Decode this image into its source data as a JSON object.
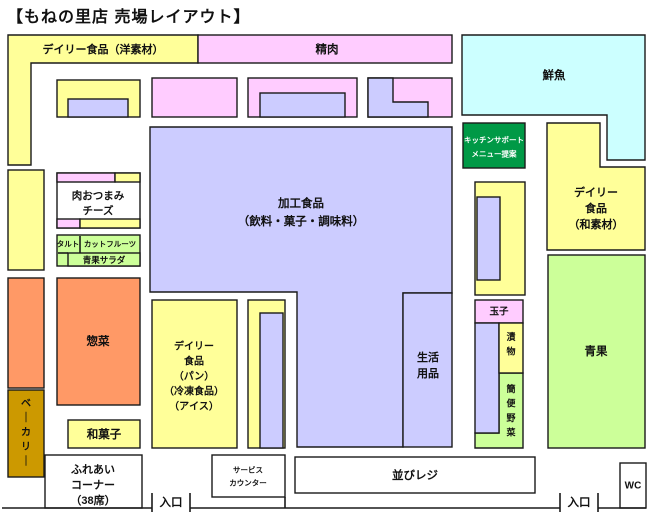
{
  "title": "【もねの里店 売場レイアウト】",
  "palette": {
    "yellow": "#FFFF99",
    "pink": "#FFCCFF",
    "lavender": "#CCCCFF",
    "cyan": "#CCFFFF",
    "green": "#009946",
    "lightgreen": "#CCFF99",
    "orange": "#FF9966",
    "gold": "#CC9900",
    "white": "#FFFFFF",
    "border": "#1A1A1A",
    "text": "#111111"
  },
  "blocks": [
    {
      "name": "daily-west",
      "points": [
        [
          8,
          35
        ],
        [
          198,
          35
        ],
        [
          198,
          63
        ],
        [
          31,
          63
        ],
        [
          31,
          165
        ],
        [
          8,
          165
        ]
      ],
      "fill": "yellow",
      "label": {
        "text": "デイリー食品（洋素材）",
        "x": 103,
        "y": 50,
        "size": 11
      }
    },
    {
      "name": "meat",
      "rect": [
        198,
        35,
        254,
        28
      ],
      "fill": "pink",
      "label": {
        "text": "精肉",
        "x": 327,
        "y": 50,
        "size": 11.5
      }
    },
    {
      "name": "fresh-fish",
      "points": [
        [
          462,
          35
        ],
        [
          645,
          35
        ],
        [
          645,
          160
        ],
        [
          607,
          160
        ],
        [
          607,
          115
        ],
        [
          462,
          115
        ]
      ],
      "fill": "cyan",
      "label": {
        "text": "鮮魚",
        "x": 554,
        "y": 76,
        "size": 11.5
      }
    },
    {
      "name": "shelf-a",
      "rect": [
        57,
        80,
        83,
        37
      ],
      "fill": "yellow"
    },
    {
      "name": "shelf-a-inner",
      "rect": [
        68,
        99,
        60,
        18
      ],
      "fill": "lavender"
    },
    {
      "name": "shelf-b",
      "rect": [
        152,
        78,
        85,
        39
      ],
      "fill": "pink"
    },
    {
      "name": "shelf-c",
      "rect": [
        248,
        78,
        109,
        39
      ],
      "fill": "pink"
    },
    {
      "name": "shelf-c-inner",
      "rect": [
        260,
        93,
        85,
        24
      ],
      "fill": "lavender"
    },
    {
      "name": "shelf-d",
      "rect": [
        368,
        78,
        84,
        39
      ],
      "fill": "pink"
    },
    {
      "name": "shelf-d-inner",
      "points": [
        [
          368,
          78
        ],
        [
          393,
          78
        ],
        [
          393,
          102
        ],
        [
          428,
          102
        ],
        [
          428,
          117
        ],
        [
          368,
          117
        ]
      ],
      "fill": "lavender"
    },
    {
      "name": "processed-food",
      "points": [
        [
          150,
          127
        ],
        [
          452,
          127
        ],
        [
          452,
          293
        ],
        [
          403,
          293
        ],
        [
          403,
          447
        ],
        [
          297,
          447
        ],
        [
          297,
          292
        ],
        [
          150,
          292
        ]
      ],
      "fill": "lavender",
      "label": {
        "lines": [
          "加工食品",
          "（飲料・菓子・調味料）"
        ],
        "x": 301,
        "y": 204,
        "size": 11.5,
        "lh": 18
      }
    },
    {
      "name": "household-goods",
      "rect": [
        403,
        293,
        49,
        154
      ],
      "fill": "lavender",
      "label": {
        "lines": [
          "生活",
          "用品"
        ],
        "x": 428,
        "y": 358,
        "size": 11,
        "lh": 16
      }
    },
    {
      "name": "kitchen-support",
      "rect": [
        463,
        123,
        62,
        45
      ],
      "fill": "green",
      "label": {
        "lines": [
          "キッチンサポート",
          "メニュー提案"
        ],
        "x": 494,
        "y": 140,
        "size": 7.5,
        "lh": 14,
        "color": "#FFFFFF"
      }
    },
    {
      "name": "daily-japanese",
      "points": [
        [
          547,
          123
        ],
        [
          600,
          123
        ],
        [
          600,
          167
        ],
        [
          645,
          167
        ],
        [
          645,
          250
        ],
        [
          547,
          250
        ]
      ],
      "fill": "yellow",
      "label": {
        "lines": [
          "デイリー",
          "食品",
          "（和素材）"
        ],
        "x": 596,
        "y": 193,
        "size": 11,
        "lh": 16
      }
    },
    {
      "name": "right-shelf",
      "rect": [
        475,
        182,
        50,
        113
      ],
      "fill": "yellow"
    },
    {
      "name": "right-shelf-inner",
      "rect": [
        477,
        197,
        23,
        83
      ],
      "fill": "lavender"
    },
    {
      "name": "eggs",
      "rect": [
        475,
        300,
        48,
        23
      ],
      "fill": "pink",
      "label": {
        "text": "玉子",
        "x": 499,
        "y": 312,
        "size": 9.5
      }
    },
    {
      "name": "simple-vegetables",
      "points": [
        [
          499,
          373
        ],
        [
          523,
          373
        ],
        [
          523,
          448
        ],
        [
          475,
          448
        ],
        [
          475,
          433
        ],
        [
          499,
          433
        ]
      ],
      "fill": "lightgreen",
      "label": {
        "text": "簡便野菜",
        "x": 511,
        "y": 389,
        "size": 9,
        "lh": 14.5,
        "vertical": true
      }
    },
    {
      "name": "pickles-shelf",
      "rect": [
        475,
        323,
        24,
        110
      ],
      "fill": "lavender"
    },
    {
      "name": "pickles",
      "rect": [
        499,
        323,
        24,
        50
      ],
      "fill": "yellow",
      "label": {
        "text": "漬物",
        "x": 511,
        "y": 337,
        "size": 9,
        "lh": 14.5,
        "vertical": true
      }
    },
    {
      "name": "produce",
      "rect": [
        548,
        255,
        97,
        193
      ],
      "fill": "lightgreen",
      "label": {
        "text": "青果",
        "x": 596,
        "y": 352,
        "size": 11.5
      }
    },
    {
      "name": "left-shelf-2",
      "rect": [
        8,
        170,
        36,
        100
      ],
      "fill": "yellow"
    },
    {
      "name": "meat-snacks",
      "rect": [
        57,
        173,
        83,
        55
      ],
      "fill": "white",
      "label": {
        "lines": [
          "肉おつまみ",
          "チーズ"
        ],
        "x": 98,
        "y": 196,
        "size": 10.5,
        "lh": 15
      }
    },
    {
      "name": "meat-snacks-strip-tl",
      "rect": [
        57,
        173,
        58,
        9
      ],
      "fill": "pink"
    },
    {
      "name": "meat-snacks-strip-tr",
      "rect": [
        115,
        173,
        25,
        9
      ],
      "fill": "yellow"
    },
    {
      "name": "meat-snacks-strip-bl",
      "rect": [
        57,
        219,
        23,
        9
      ],
      "fill": "pink"
    },
    {
      "name": "meat-snacks-strip-br",
      "rect": [
        80,
        219,
        60,
        9
      ],
      "fill": "yellow"
    },
    {
      "name": "fruit-corner",
      "rect": [
        57,
        235,
        83,
        31
      ],
      "fill": "lightgreen"
    },
    {
      "name": "produce-salad",
      "rect": [
        68,
        253,
        72,
        13
      ],
      "fill": "lightgreen",
      "label": {
        "text": "青果サラダ",
        "x": 104,
        "y": 260,
        "size": 8.5
      }
    },
    {
      "name": "tart-label",
      "label": {
        "text": "タルト",
        "x": 68,
        "y": 244,
        "size": 7.5
      }
    },
    {
      "name": "cut-fruit-label",
      "label": {
        "text": "カットフルーツ",
        "x": 110,
        "y": 244,
        "size": 7.5
      }
    },
    {
      "name": "prepared-food",
      "rect": [
        57,
        278,
        83,
        127
      ],
      "fill": "orange",
      "label": {
        "text": "惣菜",
        "x": 98,
        "y": 342,
        "size": 11.5
      }
    },
    {
      "name": "left-strip",
      "rect": [
        8,
        278,
        36,
        110
      ],
      "fill": "orange"
    },
    {
      "name": "bakery",
      "rect": [
        8,
        390,
        36,
        87
      ],
      "fill": "gold",
      "label": {
        "text": "ベーカリー",
        "x": 26,
        "y": 404,
        "size": 10,
        "lh": 14.5,
        "vertical": true
      }
    },
    {
      "name": "japanese-sweets",
      "rect": [
        68,
        420,
        72,
        28
      ],
      "fill": "yellow",
      "label": {
        "text": "和菓子",
        "x": 104,
        "y": 435,
        "size": 11.5
      }
    },
    {
      "name": "daily-bread",
      "rect": [
        152,
        300,
        85,
        148
      ],
      "fill": "yellow",
      "label": {
        "lines": [
          "デイリー",
          "食品",
          "（パン）",
          "（冷凍食品）",
          "（アイス）"
        ],
        "x": 194,
        "y": 347,
        "size": 10,
        "lh": 15
      }
    },
    {
      "name": "center-shelf",
      "rect": [
        248,
        300,
        37,
        148
      ],
      "fill": "yellow"
    },
    {
      "name": "center-shelf-inner",
      "rect": [
        260,
        313,
        23,
        135
      ],
      "fill": "lavender"
    },
    {
      "name": "community-corner",
      "rect": [
        45,
        455,
        97,
        53
      ],
      "fill": "white",
      "label": {
        "lines": [
          "ふれあい",
          "コーナー",
          "（38席）"
        ],
        "x": 93,
        "y": 470,
        "size": 11,
        "lh": 15.5
      }
    },
    {
      "name": "service-counter",
      "rect": [
        212,
        455,
        73,
        42
      ],
      "fill": "white",
      "label": {
        "lines": [
          "サービス",
          "カウンター"
        ],
        "x": 248,
        "y": 470,
        "size": 7.5,
        "lh": 13
      }
    },
    {
      "name": "checkout",
      "rect": [
        295,
        457,
        240,
        36
      ],
      "fill": "white",
      "label": {
        "text": "並びレジ",
        "x": 415,
        "y": 476,
        "size": 11.5
      }
    },
    {
      "name": "toilet",
      "rect": [
        620,
        463,
        26,
        45
      ],
      "fill": "white",
      "label": {
        "text": "WC",
        "x": 633,
        "y": 486,
        "size": 10
      }
    },
    {
      "name": "entrance-left-label",
      "label": {
        "text": "入口",
        "x": 171,
        "y": 503,
        "size": 11.5
      }
    },
    {
      "name": "entrance-right-label",
      "label": {
        "text": "入口",
        "x": 579,
        "y": 503,
        "size": 11.5
      }
    }
  ],
  "walls": [
    {
      "name": "front-wall-left",
      "line": [
        2,
        508,
        152,
        508
      ]
    },
    {
      "name": "entrance-left-tick-1",
      "line": [
        152,
        493,
        152,
        512
      ]
    },
    {
      "name": "entrance-left-tick-2",
      "line": [
        190,
        493,
        190,
        512
      ]
    },
    {
      "name": "front-wall-center",
      "line": [
        190,
        508,
        560,
        508
      ]
    },
    {
      "name": "entrance-right-tick-1",
      "line": [
        560,
        493,
        560,
        512
      ]
    },
    {
      "name": "entrance-right-tick-2",
      "line": [
        598,
        493,
        598,
        512
      ]
    },
    {
      "name": "front-wall-right",
      "line": [
        598,
        508,
        646,
        508
      ]
    },
    {
      "name": "service-counter-wall",
      "line": [
        285,
        497,
        285,
        508
      ]
    },
    {
      "name": "fruit-corner-divider-v",
      "line": [
        80,
        236,
        80,
        253
      ]
    },
    {
      "name": "fruit-corner-divider-h",
      "line": [
        58,
        253,
        68,
        253
      ]
    }
  ]
}
